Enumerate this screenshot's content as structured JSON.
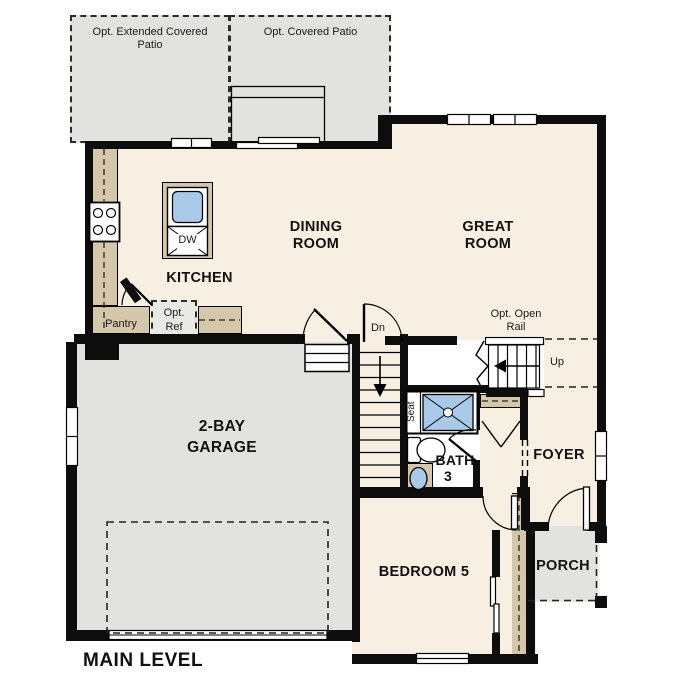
{
  "colors": {
    "floor": "#f7efe1",
    "hard": "#e2e2df",
    "counter": "#d4c7aa",
    "water": "#a9c9e9",
    "optref_fill": "#e9e9e5",
    "wall": "#0d0d0d"
  },
  "labels": {
    "patio_extended": "Opt. Extended Covered\nPatio",
    "patio_covered": "Opt. Covered Patio",
    "dining": "DINING\nROOM",
    "great": "GREAT\nROOM",
    "kitchen": "KITCHEN",
    "pantry": "Pantry",
    "opt_ref": "Opt.\nRef",
    "dishwasher": "DW",
    "stairs_down": "Dn",
    "stairs_up": "Up",
    "opt_open_rail": "Opt. Open\nRail",
    "seat": "Seat",
    "bath": "BATH",
    "bath_number": "3",
    "garage": "2-BAY\nGARAGE",
    "bedroom": "BEDROOM 5",
    "foyer": "FOYER",
    "porch": "PORCH",
    "main_level": "MAIN LEVEL"
  }
}
